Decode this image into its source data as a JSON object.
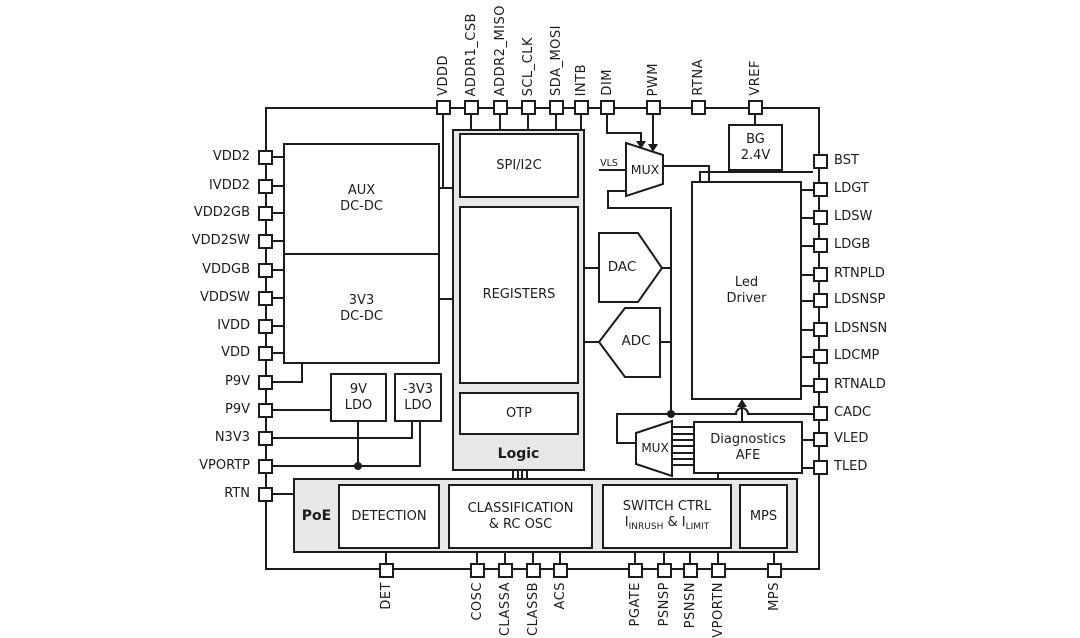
{
  "pins": {
    "top": [
      "VDDD",
      "ADDR1_CSB",
      "ADDR2_MISO",
      "SCL_CLK",
      "SDA_MOSI",
      "INTB",
      "DIM",
      "PWM",
      "RTNA",
      "VREF"
    ],
    "left": [
      "VDD2",
      "IVDD2",
      "VDD2GB",
      "VDD2SW",
      "VDDGB",
      "VDDSW",
      "IVDD",
      "VDD",
      "P9V",
      "P9V",
      "N3V3",
      "VPORTP",
      "RTN"
    ],
    "right": [
      "BST",
      "LDGT",
      "LDSW",
      "LDGB",
      "RTNPLD",
      "LDSNSP",
      "LDSNSN",
      "LDCMP",
      "RTNALD",
      "CADC",
      "VLED",
      "TLED"
    ],
    "bottom": [
      "DET",
      "COSC",
      "CLASSA",
      "CLASSB",
      "ACS",
      "PGATE",
      "PSNSP",
      "PSNSN",
      "VPORTN",
      "MPS"
    ]
  },
  "blocks": {
    "aux": {
      "l1": "AUX",
      "l2": "DC-DC"
    },
    "dcdc3v3": {
      "l1": "3V3",
      "l2": "DC-DC"
    },
    "ldo9v": {
      "l1": "9V",
      "l2": "LDO"
    },
    "ldon3v3": {
      "l1": "-3V3",
      "l2": "LDO"
    },
    "spi": "SPI/I2C",
    "registers": "REGISTERS",
    "otp": "OTP",
    "logic": "Logic",
    "mux_top": "MUX",
    "mux_bottom": "MUX",
    "dac": "DAC",
    "adc": "ADC",
    "bg": {
      "l1": "BG",
      "l2": "2.4V"
    },
    "led_driver": {
      "l1": "Led",
      "l2": "Driver"
    },
    "afe": {
      "l1": "Diagnostics",
      "l2": "AFE"
    },
    "poe": "PoE",
    "detection": "DETECTION",
    "classification": {
      "l1": "CLASSIFICATION",
      "l2": "& RC OSC"
    },
    "switch_ctrl": {
      "l1": "SWITCH CTRL",
      "i1": "I",
      "s1": "INRUSH",
      "amp": " & I",
      "s2": "LIMIT"
    },
    "mps": "MPS"
  },
  "wire_labels": {
    "vls": "VLS"
  },
  "colors": {
    "line": "#1c1c1c",
    "group_fill": "#e7e7e7",
    "block_fill": "#ffffff",
    "background": "#ffffff"
  }
}
